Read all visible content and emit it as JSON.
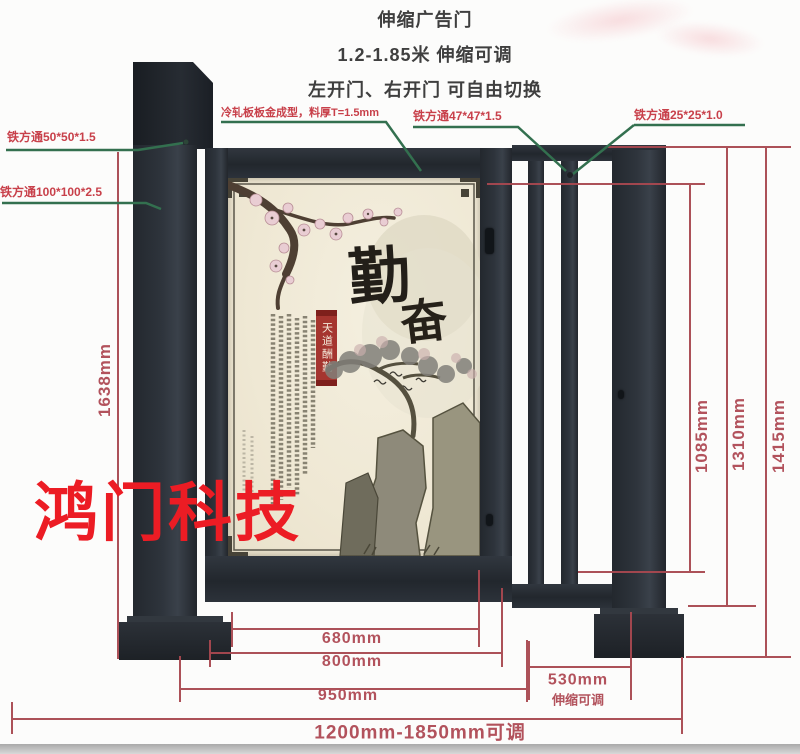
{
  "header": {
    "line1": "伸缩广告门",
    "line2": "1.2-1.85米 伸缩可调",
    "line3": "左开门、右开门 可自由切换"
  },
  "part_labels": {
    "square_tube_50": "铁方通50*50*1.5",
    "square_tube_100": "铁方通100*100*2.5",
    "cold_rolled_sheet": "冷轧板板金成型，料厚T=1.5mm",
    "square_tube_47": "铁方通47*47*1.5",
    "square_tube_25": "铁方通25*25*1.0"
  },
  "dimensions": {
    "frame_height": "1638mm",
    "fence_height": "1085mm",
    "gate_height": "1310mm",
    "total_height": "1415mm",
    "poster_width": "680mm",
    "door_width": "800mm",
    "door_outer_width": "950mm",
    "telescopic_width": "530mm",
    "telescopic_note": "伸缩可调",
    "total_width": "1200mm-1850mm可调"
  },
  "poster": {
    "calligraphy_main": "勤",
    "calligraphy_sub": "奋",
    "banner_text": "天道酬勤"
  },
  "watermark": "鸿门科技",
  "colors": {
    "dimension_line": "#a84850",
    "dimension_text": "#b2525c",
    "part_label_text": "#c8404a",
    "leader_line": "#33704f",
    "metal": "#272c33",
    "watermark_red": "#ec1c24",
    "poster_cream": "#f1ecdb"
  }
}
